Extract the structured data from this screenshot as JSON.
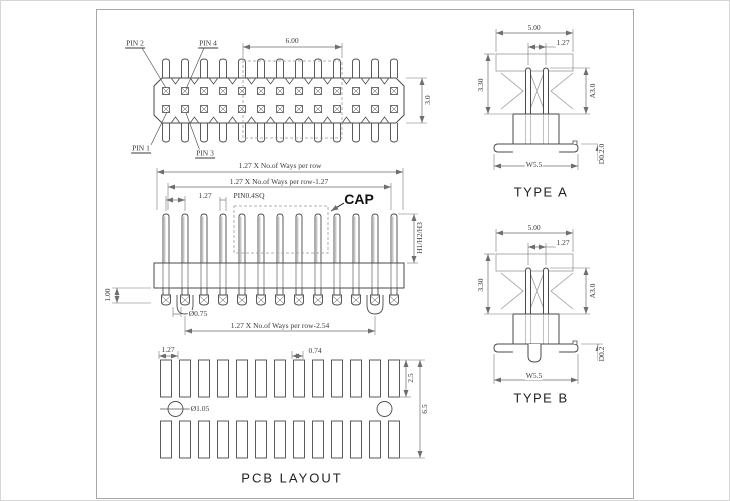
{
  "top_view": {
    "pin1": "PIN 1",
    "pin2": "PIN 2",
    "pin3": "PIN 3",
    "pin4": "PIN 4",
    "dim_cap_width": "6.00",
    "dim_body_height": "3.0"
  },
  "front_view": {
    "dim_row_total": "1.27 X No.of Ways per row",
    "dim_row_minus_127": "1.27 X No.of Ways per row-1.27",
    "dim_pitch": "1.27",
    "pin_size_label": "PIN0.4SQ",
    "cap_label": "CAP",
    "dim_heights": "H1/H2/H3",
    "dim_standoff": "1.00",
    "dim_pin_dia": "Ø0.75",
    "dim_row_minus_254": "1.27 X No.of Ways per row-2.54"
  },
  "pcb_layout": {
    "title": "PCB LAYOUT",
    "dim_pitch": "1.27",
    "dim_pad_width": "0.74",
    "dim_pad_height": "2.5",
    "dim_row_span": "6.5",
    "dim_hole_dia": "Ø1.05"
  },
  "type_a": {
    "title": "TYPE A",
    "dim_width": "5.00",
    "dim_pitch": "1.27",
    "dim_height_left": "3.30",
    "dim_height_right": "A3.0",
    "dim_lead_span": "W5.5",
    "dim_lead_thk": "D0.2.0"
  },
  "type_b": {
    "title": "TYPE B",
    "dim_width": "5.00",
    "dim_pitch": "1.27",
    "dim_height_left": "3.30",
    "dim_height_right": "A3.0",
    "dim_lead_span": "W5.5",
    "dim_lead_thk": "D0.2"
  },
  "drawing": {
    "ways_per_row": 13,
    "rows": 2,
    "pcb_pads_per_row": 13,
    "pitch_px": 19,
    "first_pin_x": 165,
    "pad_row_y_top": 359,
    "pad_row_y_bottom": 420,
    "colors": {
      "part_line": "#4a4a4a",
      "light_line": "#9a9a9a",
      "dim_line": "#6e6e6e",
      "frame": "#a8a8a8",
      "text": "#3a3a3a",
      "background": "#ffffff"
    }
  }
}
